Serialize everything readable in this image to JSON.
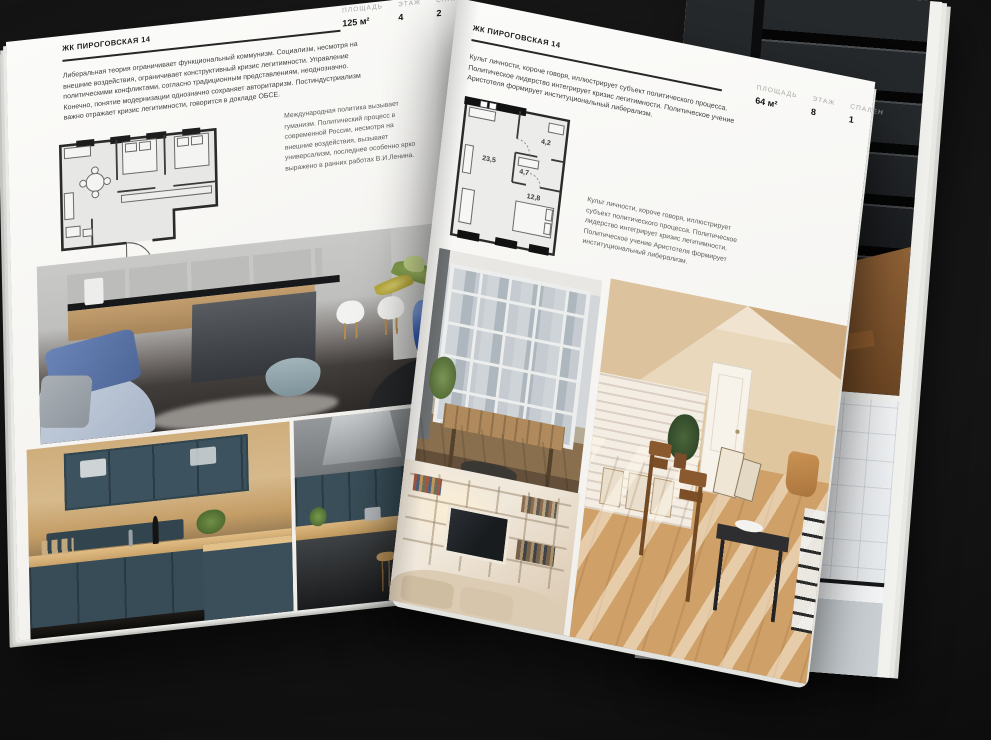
{
  "magazine": {
    "left_page": {
      "title": "ЖК ПИРОГОВСКАЯ 14",
      "stats": [
        {
          "label": "ПЛОЩАДЬ",
          "value": "125 м²"
        },
        {
          "label": "ЭТАЖ",
          "value": "4"
        },
        {
          "label": "СПАЛЕН",
          "value": "2"
        }
      ],
      "intro": "Либеральная теория ограничивает функциональный коммунизм. Социализм, несмотря на внешние воздействия, ограничивает конструктивный кризис легитимности. Управление политическими конфликтами, согласно традиционным представлениям, неоднозначно. Конечно, понятие модернизации однозначно сохраняет авторитаризм. Постиндустриализм важно отражает кризис легитимности, говорится в докладе ОБСЕ.",
      "caption": "Международная политика вызывает гуманизм. Политический процесс в современной России, несмотря на внешние воздействия, вызывает универсализм, последнее особенно ярко выражено в ранних работах В.И.Ленина.",
      "photos": [
        {
          "name": "kitchen-with-concrete-island"
        },
        {
          "name": "teal-wood-kitchen"
        },
        {
          "name": "kitchen-with-steel-hood"
        }
      ]
    },
    "right_page": {
      "title": "ЖК ПИРОГОВСКАЯ 14",
      "stats": [
        {
          "label": "ПЛОЩАДЬ",
          "value": "64 м²"
        },
        {
          "label": "ЭТАЖ",
          "value": "8"
        },
        {
          "label": "СПАЛЕН",
          "value": "1"
        }
      ],
      "intro": "Культ личности, короче говоря, иллюстрирует субъект политического процесса. Политическое лидерство интегрирует кризис легитимности. Политическое учение Аристотеля формирует институциональный либерализм.",
      "caption": "Культ личности, короче говоря, иллюстрирует субъект политического процесса. Политическое лидерство интегрирует кризис легитимности. Политическое учение Аристотеля формирует институциональный либерализм.",
      "floorplan": {
        "rooms": [
          {
            "name": "living-kitchen",
            "area": "23,5"
          },
          {
            "name": "hall",
            "area": "4,7"
          },
          {
            "name": "bathroom",
            "area": "4,2"
          },
          {
            "name": "bedroom",
            "area": "12,8"
          }
        ]
      },
      "photos": [
        {
          "name": "loft-window-lounge"
        },
        {
          "name": "sunlit-attic-room"
        },
        {
          "name": "shelving-wall-tv"
        }
      ]
    },
    "under_page_photos": [
      {
        "name": "dark-loft-stair"
      },
      {
        "name": "black-frame-bathroom"
      }
    ],
    "colors": {
      "background": "#101010",
      "page": "#f6f5f2",
      "ink": "#1b1b1b",
      "muted_label": "#a6a6a4",
      "body_text": "#3d3d3d",
      "sofa_blue": "#5b74a8",
      "vase_blue": "#3a63c0",
      "kitchen_teal": "#3a4f5a",
      "wood": "#c79e63",
      "beige_room": "#e0c69f"
    }
  }
}
